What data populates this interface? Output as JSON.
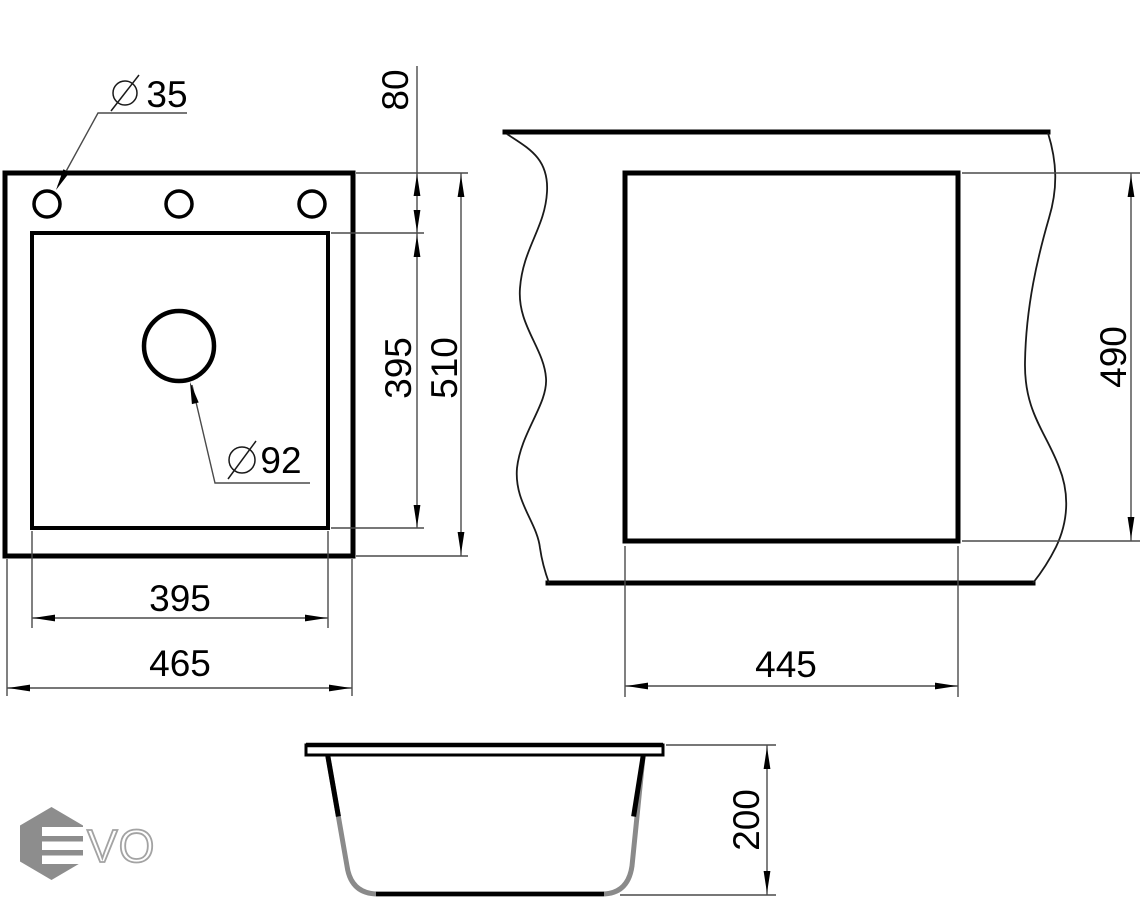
{
  "page": {
    "background": "#ffffff"
  },
  "drawing": {
    "diameter_symbol": "⌀",
    "top_view": {
      "hole_diameter": "35",
      "hole_row_offset": "80",
      "drain_diameter": "92",
      "bowl_length": "395",
      "overall_length": "510",
      "bowl_width": "395",
      "overall_width": "465"
    },
    "cutout_view": {
      "cutout_width": "445",
      "cutout_length": "490"
    },
    "section_view": {
      "bowl_depth": "200"
    },
    "colors": {
      "outline": "#000000",
      "dimension_line": "#4a4a4a",
      "logo_gray": "#8d8d8d"
    }
  },
  "logo": {
    "wordmark": "VO"
  }
}
